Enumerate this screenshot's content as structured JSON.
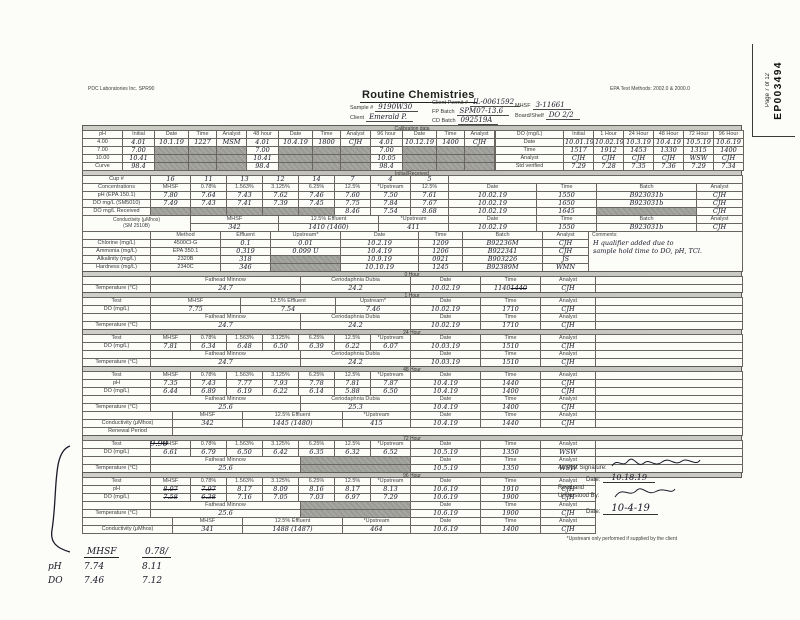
{
  "page": {
    "lab": "PDC Laboratories Inc. SPR90",
    "epa_methods": "EPA Test Methods: 2002.0 & 2000.0",
    "page_stamp": "Page 7 of 12",
    "doc_stamp": "EP003494",
    "title": "Routine Chemistries"
  },
  "header": {
    "sample_label": "Sample #",
    "sample_value": "9190W30",
    "client_label": "Client",
    "client_value": "Emerald P.",
    "permit_label": "Client Permit #",
    "permit_value": "IL-0061592",
    "fp_batch_label": "FP Batch",
    "fp_batch_value": "SPM07-13.6",
    "cd_batch_label": "CD Batch",
    "cd_batch_value": "092519A",
    "mhsf_label": "MHSF",
    "mhsf_value": "3-11661",
    "board_label": "Board/Shelf",
    "board_value": "DO 2/2"
  },
  "bands": {
    "calibration": "Calibration data",
    "initial": "Initial/Received",
    "h0": "0 Hour",
    "h1": "1 Hour",
    "h24": "24 Hour",
    "h48": "48 Hour",
    "h72": "72 Hour",
    "h96": "96 Hour"
  },
  "footnote": "*Upstream only performed if supplied by the client",
  "annotations": {
    "struck": "9.90"
  },
  "notes": {
    "c1": "MHSF",
    "c2": "0.78/",
    "r1k": "pH",
    "r1a": "7.74",
    "r1b": "8.11",
    "r2k": "DO",
    "r2a": "7.46",
    "r2b": "7.12"
  },
  "signature": {
    "analyst_label": "Analyst Signature:",
    "date_label": "Date:",
    "analyst_date": "10.18.19",
    "read_label": "Read and Understood By:",
    "read_date": "10-4-19"
  },
  "tables": {
    "calib_ph": {
      "w": [
        40,
        32,
        34,
        28,
        30,
        32,
        34,
        28,
        30,
        32,
        34,
        28,
        30
      ],
      "hr": [
        0
      ],
      "rows": [
        [
          "pH",
          "Initial",
          "Date",
          "Time",
          "Analyst",
          "48 hour",
          "Date",
          "Time",
          "Analyst",
          "96 hour",
          "Date",
          "Time",
          "Analyst"
        ],
        [
          "4.00",
          "^4.01",
          "^10.1.19",
          "^1227",
          "^MSM",
          "^4.01",
          "^10.4.19",
          "^1800",
          "^CJH",
          "^4.01",
          "^10.12.19",
          "^1400",
          "^CJH"
        ],
        [
          "7.00",
          "^7.00",
          "%%",
          "%%",
          "%%",
          "^7.00",
          "%%",
          "%%",
          "%%",
          "^7.00",
          "%%",
          "%%",
          "%%"
        ],
        [
          "10.00",
          "^10.41",
          "%%",
          "%%",
          "%%",
          "^10.41",
          "%%",
          "%%",
          "%%",
          "^10.05",
          "%%",
          "%%",
          "%%"
        ],
        [
          "Curve",
          "^98.4",
          "%%",
          "%%",
          "%%",
          "^98.4",
          "%%",
          "%%",
          "%%",
          "^98.4",
          "%%",
          "%%",
          "%%"
        ]
      ]
    },
    "calib_do": {
      "w": [
        68,
        30,
        30,
        30,
        30,
        30,
        30
      ],
      "hr": [
        0
      ],
      "rows": [
        [
          "DO (mg/L)",
          "Initial",
          "1 Hour",
          "24 Hour",
          "48 Hour",
          "72 Hour",
          "96 Hour"
        ],
        [
          "Date",
          "^10.01.19",
          "^10.02.19",
          "^10.3.19",
          "^10.4.19",
          "^10.5.19",
          "^10.6.19"
        ],
        [
          "Time",
          "^1517",
          "^1912",
          "^1453",
          "^1330",
          "^1315",
          "^1400"
        ],
        [
          "Analyst",
          "^CJH",
          "^CJH",
          "^CJH",
          "^CJH",
          "^WSW",
          "^CJH"
        ],
        [
          "Std verified",
          "^7.29",
          "^7.28",
          "^7.35",
          "^7.36",
          "^7.29",
          "^7.34"
        ]
      ]
    },
    "conc": {
      "w": [
        68,
        40,
        36,
        36,
        36,
        36,
        36,
        40,
        38,
        88,
        60,
        100,
        46
      ],
      "hr": [
        1
      ],
      "rows": [
        [
          "Cup #",
          "^16",
          "^11",
          "^13",
          "^12",
          "^14",
          "^7",
          "^4",
          "^5",
          {
            "v": "",
            "s": 4
          }
        ],
        [
          "Concentrations",
          "MHSF",
          "0.78%",
          "1.563%",
          "3.125%",
          "6.25%",
          "12.5%",
          "*Upstream",
          "12.5%",
          "Date",
          "Time",
          "Batch",
          "Analyst"
        ],
        [
          "pH (EPA 150.1)",
          "^7.80",
          "^7.64",
          "^7.43",
          "^7.62",
          "^7.46",
          "^7.60",
          "^7.50",
          "^7.61",
          "^10.02.19",
          "^1550",
          "^B923031b",
          "^CJH"
        ],
        [
          "DO mg/L (SM5010)",
          "^7.49",
          "^7.43",
          "^7.41",
          "^7.39",
          "^7.45",
          "^7.75",
          "^7.84",
          "^7.67",
          "^10.02.19",
          "^1650",
          "^B923031b",
          "^CJH"
        ],
        [
          "DO mg/L Received",
          "%%",
          "%%",
          "%%",
          "%%",
          "%%",
          "^8.46",
          "^7.54",
          "^8.68",
          "^10.02.19",
          "^1645",
          "%%",
          "^CJH"
        ]
      ]
    },
    "cond1": {
      "w": [
        108,
        88,
        100,
        70,
        88,
        60,
        100,
        46
      ],
      "hr": [
        0
      ],
      "rows": [
        [
          {
            "v": "Conductivity (μMhos)\n(SM 2510B)",
            "r": 2,
            "c": "lab pre"
          },
          "MHSF",
          "12.5% Effluent",
          "*Upstream",
          "Date",
          "Time",
          "Batch",
          "Analyst"
        ],
        [
          "^342",
          "^1410 (1460)",
          "^411",
          "^10.02.19",
          "^1550",
          "^B923031b",
          "^CJH"
        ]
      ]
    },
    "method": {
      "w": [
        68,
        70,
        50,
        70,
        78,
        44,
        80,
        46,
        154
      ],
      "hr": [
        0
      ],
      "rows": [
        [
          "",
          "Method",
          "Effluent",
          "Upstream*",
          "Date",
          "Time",
          "Batch",
          "Analyst",
          {
            "label": "Comments:",
            "v": "H qualifier added due to\nsample hold time to DO, pH, TCl.",
            "r": 5,
            "c": "cm",
            "n": "comments-cell"
          }
        ],
        [
          "Chlorine (mg/L)",
          "4500Cl-G",
          "^0.1",
          "^0.01",
          "^10.2.19",
          "^1209",
          "^B92236M",
          "^CJH"
        ],
        [
          "Ammonia (mg/L)",
          "EPA 350.1",
          "^0.319",
          "^0.099 U",
          "^10.4.19",
          "^1206",
          "^B922341",
          "^CJH"
        ],
        [
          "Alkalinity (mg/L)",
          "2320B",
          "^318",
          "%%",
          "^10.9.19",
          "^0921",
          "^B903226",
          "^JS"
        ],
        [
          "Hardness (mg/L)",
          "2340C",
          "^346",
          "%%",
          "^10.10.19",
          "^1245",
          "^B92389M",
          "^WMN"
        ]
      ]
    },
    "h0_temp": {
      "w": [
        68,
        150,
        110,
        70,
        60,
        55,
        147
      ],
      "hr": [
        0
      ],
      "rows": [
        [
          "",
          "Fathead Minnow",
          "Ceriodaphnia Dubia",
          "Date",
          "Time",
          "Analyst",
          ""
        ],
        [
          "Temperature (°C)",
          "^24.7",
          "^24.2",
          "^10.02.19",
          {
            "v": "1140",
            "st": "1440",
            "c": "hw"
          },
          "^CJH",
          ""
        ]
      ]
    },
    "h1": {
      "w": [
        68,
        90,
        95,
        75,
        70,
        60,
        55,
        147
      ],
      "hr": [
        0
      ],
      "rows": [
        [
          "Test",
          "MHSF",
          "12.5% Effluent",
          "Upstream*",
          "Date",
          "Time",
          "Analyst",
          ""
        ],
        [
          "DO (mg/L)",
          "^7.75",
          "^7.54",
          "^7.46",
          "^10.02.19",
          "^1710",
          "^CJH",
          ""
        ]
      ]
    },
    "h1_temp": {
      "w": [
        68,
        150,
        110,
        70,
        60,
        55,
        147
      ],
      "hr": [
        0
      ],
      "rows": [
        [
          "",
          "Fathead Minnow",
          "Ceriodaphnia Dubia",
          "Date",
          "Time",
          "Analyst",
          ""
        ],
        [
          "Temperature (°C)",
          "^24.7",
          "^24.2",
          "^10.02.19",
          "^1710",
          "^CJH",
          ""
        ]
      ]
    },
    "h24": {
      "w": [
        68,
        40,
        36,
        36,
        36,
        36,
        36,
        40,
        70,
        60,
        55,
        147
      ],
      "hr": [
        0
      ],
      "rows": [
        [
          "Test",
          "MHSF",
          "0.78%",
          "1.563%",
          "3.125%",
          "6.25%",
          "12.5%",
          "*Upstream",
          "Date",
          "Time",
          "Analyst",
          ""
        ],
        [
          "DO (mg/L)",
          "^7.81",
          "^6.34",
          "^6.48",
          "^6.50",
          "^6.39",
          "^6.22",
          "^6.07",
          "^10.03.19",
          "^1510",
          "^CJH",
          ""
        ]
      ]
    },
    "h24_temp": {
      "w": [
        68,
        150,
        110,
        70,
        60,
        55,
        147
      ],
      "hr": [
        0
      ],
      "rows": [
        [
          "",
          "Fathead Minnow",
          "Ceriodaphnia Dubia",
          "Date",
          "Time",
          "Analyst",
          ""
        ],
        [
          "Temperature (°C)",
          "^24.7",
          "^24.2",
          "^10.03.19",
          "^1510",
          "^CJH",
          ""
        ]
      ]
    },
    "h48": {
      "w": [
        68,
        40,
        36,
        36,
        36,
        36,
        36,
        40,
        70,
        60,
        55,
        147
      ],
      "hr": [
        0
      ],
      "rows": [
        [
          "Test",
          "MHSF",
          "0.78%",
          "1.563%",
          "3.125%",
          "6.25%",
          "12.5%",
          "*Upstream",
          "Date",
          "Time",
          "Analyst",
          ""
        ],
        [
          "pH",
          "^7.35",
          "^7.43",
          "^7.77",
          "^7.93",
          "^7.78",
          "^7.81",
          "^7.87",
          "^10.4.19",
          "^1440",
          "^CJH",
          ""
        ],
        [
          "DO (mg/L)",
          "^6.44",
          "^6.89",
          "^6.19",
          "^6.22",
          "^6.14",
          "^5.88",
          "^6.50",
          "^10.4.19",
          "^1400",
          "^CJH",
          ""
        ]
      ]
    },
    "h48_temp": {
      "w": [
        68,
        150,
        110,
        70,
        60,
        55,
        147
      ],
      "hr": [
        0
      ],
      "rows": [
        [
          "",
          "Fathead Minnow",
          "Ceriodaphnia Dubia",
          "Date",
          "Time",
          "Analyst",
          ""
        ],
        [
          "Temperature (°C)",
          "^25.6",
          "^25.3",
          "^10.4.19",
          "^1400",
          "^CJH",
          ""
        ]
      ]
    },
    "h48_cond": {
      "w": [
        90,
        70,
        100,
        68,
        70,
        60,
        55,
        147
      ],
      "hr": [
        0
      ],
      "rows": [
        [
          "",
          "MHSF",
          "12.5% Effluent",
          "*Upstream",
          "Date",
          "Time",
          "Analyst",
          ""
        ],
        [
          "Conductivity (μMhos)",
          "^342",
          "^1445 (1480)",
          "^415",
          "^10.4.19",
          "^1440",
          "^CJH",
          ""
        ],
        [
          "Renewal Period",
          {
            "v": "",
            "s": 7
          }
        ]
      ]
    },
    "h72": {
      "w": [
        68,
        40,
        36,
        36,
        36,
        36,
        36,
        40,
        70,
        60,
        55,
        147
      ],
      "hr": [
        0
      ],
      "rows": [
        [
          "Test",
          "MHSF",
          "0.78%",
          "1.563%",
          "3.125%",
          "6.25%",
          "12.5%",
          "*Upstream",
          "Date",
          "Time",
          "Analyst",
          ""
        ],
        [
          "DO (mg/L)",
          "^6.61",
          "^6.79",
          "^6.50",
          "^6.42",
          "^6.35",
          "^6.32",
          "^6.52",
          "^10.5.19",
          "^1350",
          "^WSW",
          ""
        ]
      ]
    },
    "h72_temp": {
      "w": [
        68,
        150,
        110,
        70,
        60,
        55,
        147
      ],
      "hr": [
        0
      ],
      "rows": [
        [
          "",
          "Fathead Minnow",
          "%%",
          "Date",
          "Time",
          "Analyst",
          ""
        ],
        [
          "Temperature (°C)",
          "^25.6",
          "%%",
          "^10.5.19",
          "^1350",
          "^WSW",
          ""
        ]
      ]
    },
    "h96": {
      "w": [
        68,
        40,
        36,
        36,
        36,
        36,
        36,
        40,
        70,
        60,
        55
      ],
      "hr": [
        0
      ],
      "rows": [
        [
          "Test",
          "MHSF",
          "0.78%",
          "1.563%",
          "3.125%",
          "6.25%",
          "12.5%",
          "*Upstream",
          "Date",
          "Time",
          "Analyst"
        ],
        [
          "pH",
          {
            "st": "8.07",
            "c": "hw"
          },
          {
            "st": "7.97",
            "c": "hw"
          },
          "^8.17",
          "^8.09",
          "^8.16",
          "^8.17",
          "^8.13",
          "^10.6.19",
          "^1910",
          "^CJH"
        ],
        [
          "DO (mg/L)",
          {
            "st": "7.58",
            "c": "hw"
          },
          {
            "st": "6.38",
            "c": "hw"
          },
          "^7.16",
          "^7.05",
          "^7.03",
          "^6.97",
          "^7.29",
          "^10.6.19",
          "^1900",
          "^CJH"
        ]
      ]
    },
    "h96_temp": {
      "w": [
        68,
        150,
        110,
        70,
        60,
        55
      ],
      "hr": [
        0
      ],
      "rows": [
        [
          "",
          "Fathead Minnow",
          "%%",
          "Date",
          "Time",
          "Analyst"
        ],
        [
          "Temperature (°C)",
          "^25.6",
          "%%",
          "^10.6.19",
          "^1900",
          "^CJH"
        ]
      ]
    },
    "h96_cond": {
      "w": [
        90,
        70,
        100,
        68,
        70,
        60,
        55
      ],
      "hr": [
        0
      ],
      "rows": [
        [
          "",
          "MHSF",
          "12.5% Effluent",
          "*Upstream",
          "Date",
          "Time",
          "Analyst"
        ],
        [
          "Conductivity (μMhos)",
          "^341",
          "^1488 (1487)",
          "^464",
          "^10.6.19",
          "^1400",
          "^CJH"
        ]
      ]
    }
  }
}
